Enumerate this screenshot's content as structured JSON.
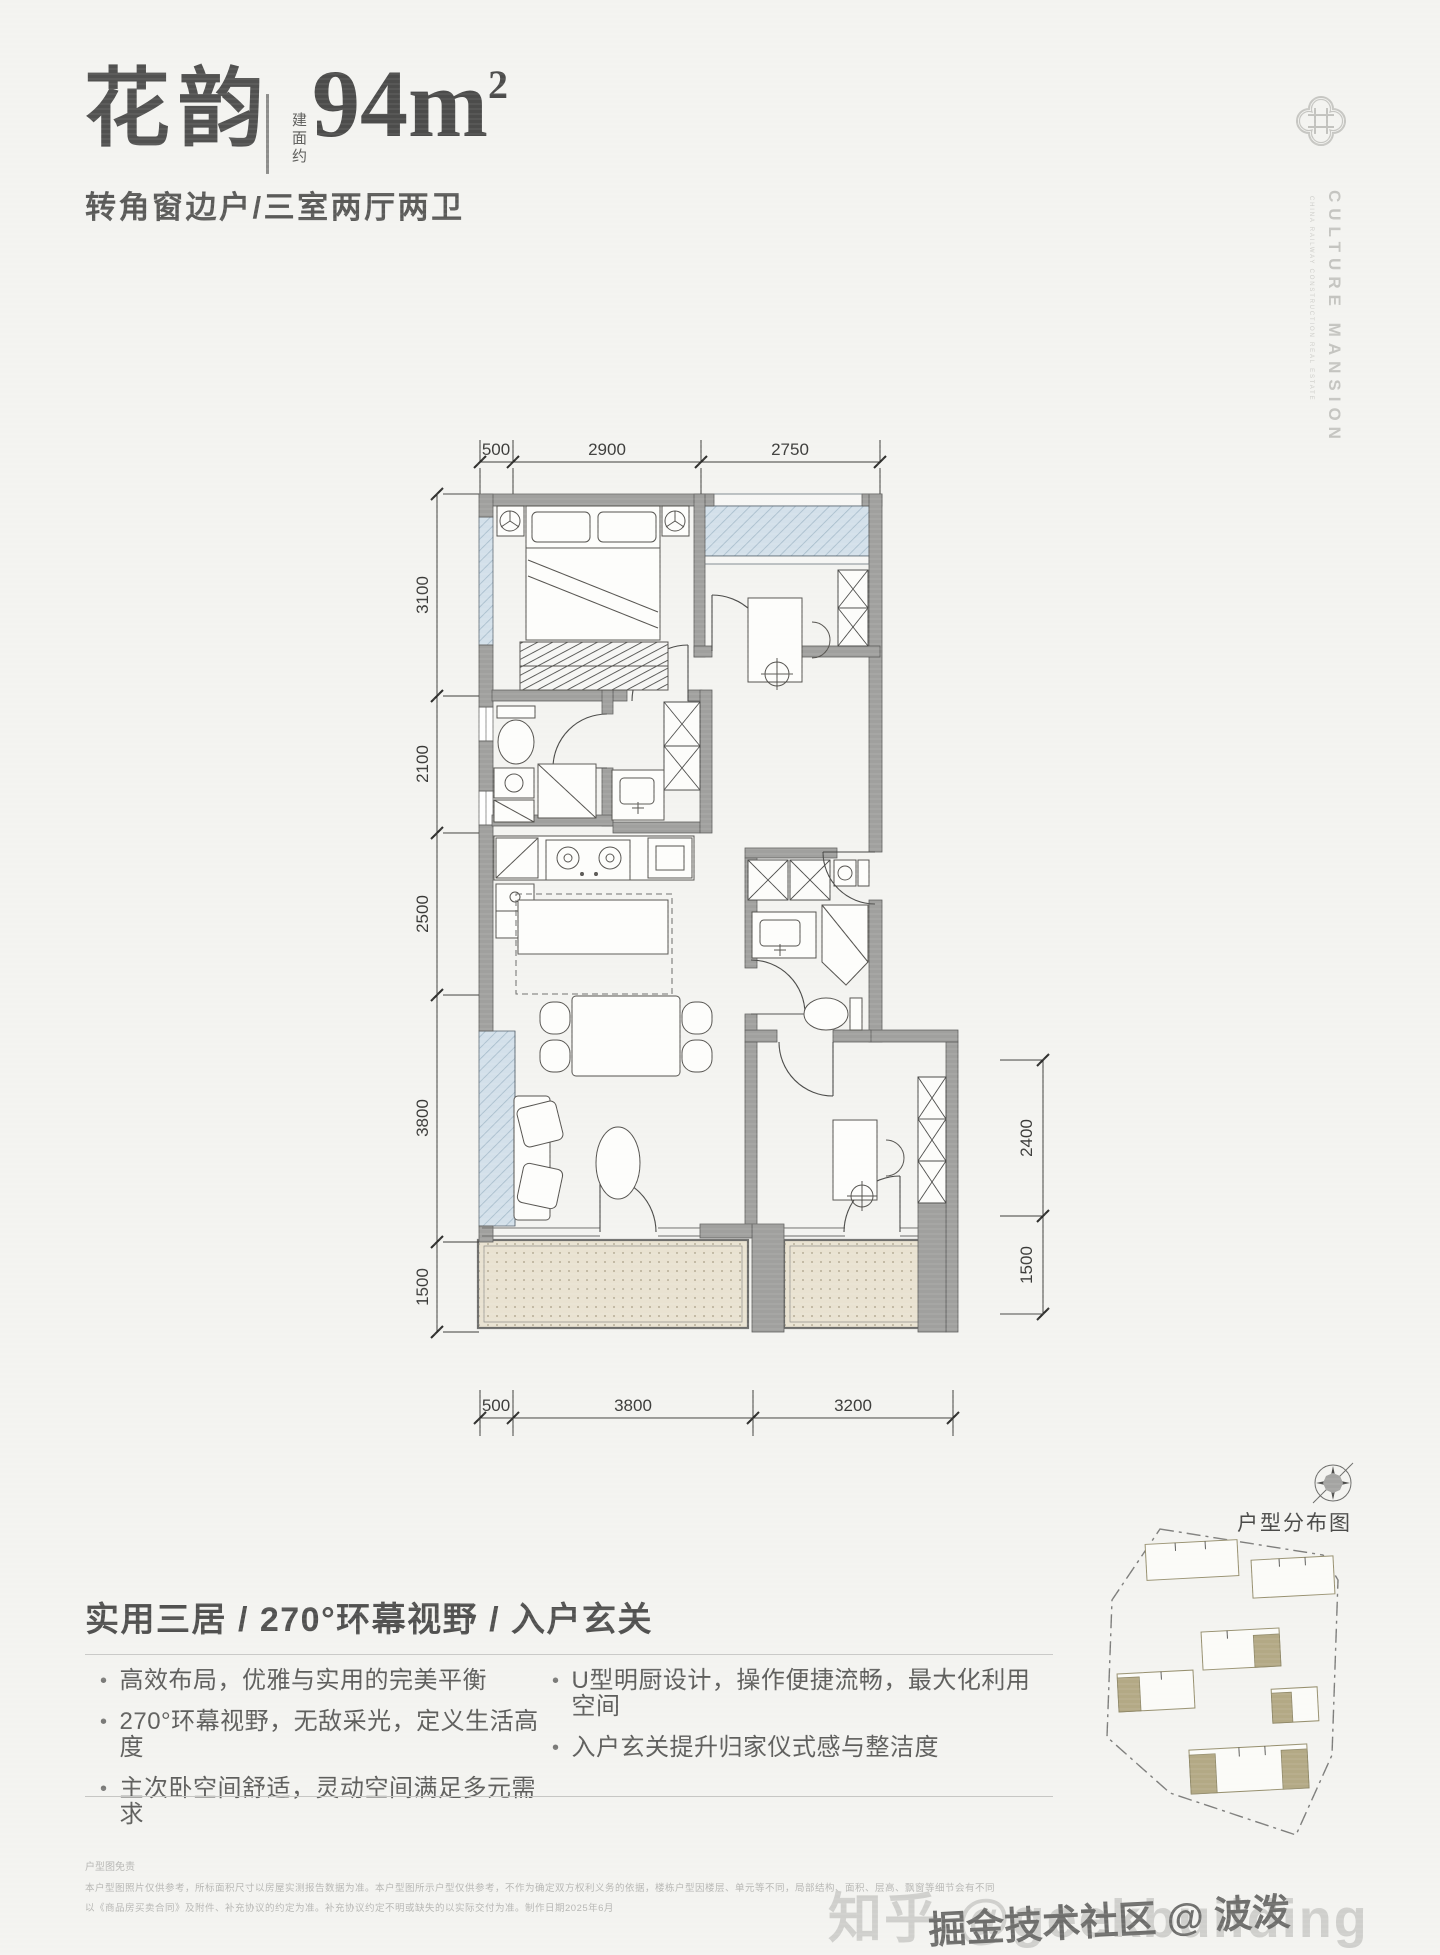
{
  "header": {
    "title": "花韵",
    "area_label_vertical": "建面约",
    "area_value": "94m",
    "area_superscript": "2",
    "subtitle": "转角窗边户/三室两厅两卫"
  },
  "brand": {
    "logo_icon": "quatrefoil-emblem-icon",
    "name": "CULTURE MANSION",
    "tagline": "CHINA RAILWAY CONSTRUCTION REAL ESTATE"
  },
  "floorplan": {
    "dims_top": [
      "500",
      "2900",
      "2750"
    ],
    "dims_left": [
      "3100",
      "2100",
      "2500",
      "3800",
      "1500"
    ],
    "dims_right": [
      "2400",
      "1500"
    ],
    "dims_bottom": [
      "500",
      "3800",
      "3200"
    ]
  },
  "features": {
    "heading": "实用三居 / 270°环幕视野 / 入户玄关",
    "bullet_glyph": "•",
    "bullets_left": [
      "高效布局，优雅与实用的完美平衡",
      "270°环幕视野，无敌采光，定义生活高度",
      "主次卧空间舒适，灵动空间满足多元需求"
    ],
    "bullets_right": [
      "U型明厨设计，操作便捷流畅，最大化利用空间",
      "入户玄关提升归家仪式感与整洁度"
    ]
  },
  "siteplan": {
    "label": "户型分布图",
    "compass_icon": "compass-icon"
  },
  "disclaimer": {
    "title": "户型图免责",
    "line1": "本户型图照片仅供参考，所标面积尺寸以房屋实测报告数据为准。本户型图所示户型仅供参考，不作为确定双方权利义务的依据，楼栋户型因楼层、单元等不同，局部结构、面积、层高、飘窗等细节会有不同",
    "line2": "以《商品房买卖合同》及附件、补充协议的约定为准。补充协议约定不明或缺失的以实际交付为准。制作日期2025年6月"
  },
  "watermarks": {
    "zhihu": "知乎 @geekbuilding",
    "juejin": "掘金技术社区 @ 波泼"
  }
}
